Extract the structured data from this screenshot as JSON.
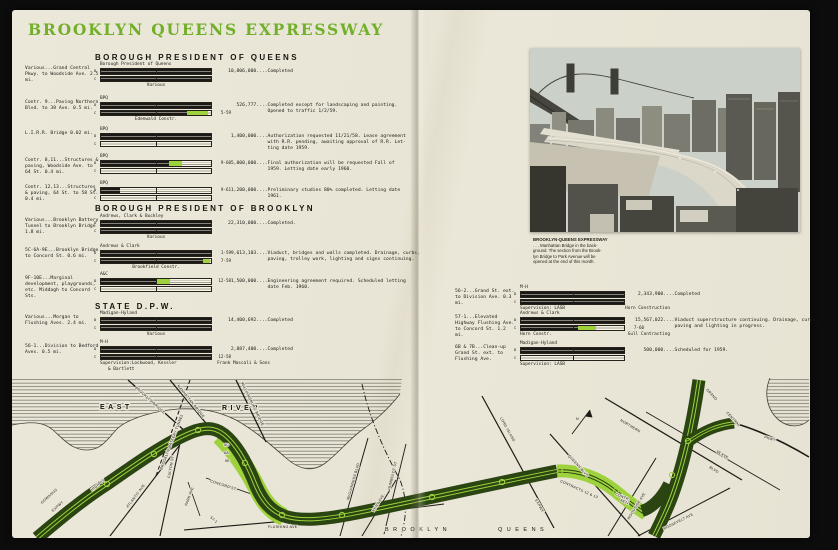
{
  "title": "BROOKLYN QUEENS EXPRESSWAY",
  "colors": {
    "accent_green": "#72b02a",
    "bar_green": "#9ed23d",
    "map_dark_green": "#2a4511",
    "map_light_green": "#9ed23d",
    "page_cream": "#e9e5d7"
  },
  "bars": {
    "d": "D",
    "c": "C"
  },
  "left": {
    "sections": [
      {
        "header": "BOROUGH PRESIDENT OF QUEENS",
        "rows": [
          {
            "label": "Various...Grand Central Pkwy. to Woodside Ave. 2.5 mi.",
            "top": "Borough President of Queens",
            "bottom": "Various",
            "d_black": 1,
            "d_green": 0,
            "c_black": 1,
            "c_green": 0,
            "amount": "10,806,000....Completed"
          },
          {
            "label": "Contr. 9...Paving Northern Blvd. to 38 Ave.  0.5 mi.",
            "top": "BPQ",
            "bottom": "Edenwald Constr.",
            "date_c": "5-59",
            "d_black": 1,
            "d_green": 0,
            "c_black": 0.78,
            "c_green": 0.19,
            "amount": "   526,777....Completed except for landscaping and painting.\n              Opened to traffic 1/2/59."
          },
          {
            "label": "L.I.R.R. Bridge 0.02 mi.",
            "top": "BPQ",
            "d_black": 1,
            "d_green": 0,
            "c_black": 0,
            "c_green": 0,
            "amount": " 1,400,000....Authorization requested 11/21/58. Lease agreement\n              with R.R. pending, awaiting approval of R.R. Let-\n              ting date 1959."
          },
          {
            "label": "Contr. 8,11...Structures & paving, Woodside Ave. to 64 St. 0.4 mi.",
            "top": "BPQ",
            "date_d": "9-60",
            "d_black": 0.62,
            "d_green": 0.12,
            "c_black": 0,
            "c_green": 0,
            "amount": " 5,000,000....Final authorization will be requested Fall of\n              1959. Letting date early 1960."
          },
          {
            "label": "Contr. 12,13...Structures & paving, 64 St. to 58 St.  0.4 mi.",
            "top": "BPQ",
            "date_d": "9-61",
            "d_black": 0.17,
            "d_green": 0,
            "c_black": 0,
            "c_green": 0,
            "amount": " 1,200,000....Preliminary studies 80% completed. Letting date\n              1961."
          }
        ]
      },
      {
        "header": "BOROUGH PRESIDENT OF BROOKLYN",
        "rows": [
          {
            "label": "Various...Brooklyn Battery Tunnel to Brooklyn Bridge 1.8 mi.",
            "top": "Andrews, Clark & Buckley",
            "bottom": "Various",
            "d_black": 1,
            "d_green": 0,
            "c_black": 1,
            "c_green": 0,
            "amount": "22,310,000....Completed."
          },
          {
            "label": "5C-6A-9E...Brooklyn Bridge to Concord St. 0.6 mi.",
            "top": "Andrews & Clark",
            "bottom": "Brookfield Constr.",
            "date_d": "1-59",
            "date_c": "7-59",
            "d_black": 1,
            "d_green": 0,
            "c_black": 0.93,
            "c_green": 0.06,
            "amount": " 9,613,103....Viaduct, bridges and walls completed. Drainage, curbs,\n              paving, trolley work, lighting and signs continuing."
          },
          {
            "label": "9F-10E...Marginal development, playgrounds, etc. Middagh to Concord Sts.",
            "top": "A&C",
            "date_d": "12-58",
            "d_black": 0.5,
            "d_green": 0.13,
            "c_black": 0,
            "c_green": 0,
            "amount": " 1,500,000....Engineering agreement required. Scheduled letting\n              date Feb. 1960."
          }
        ]
      },
      {
        "header": "STATE D.P.W.",
        "rows": [
          {
            "label": "Various...Morgan to Flushing Aves. 2.4 mi.",
            "top": "Madigan-Hyland",
            "bottom": "Various",
            "d_black": 1,
            "d_green": 0,
            "c_black": 1,
            "c_green": 0,
            "amount": "14,400,692....Completed"
          },
          {
            "label": "56-1...Division to Bedford Aves. 0.5 mi.",
            "top": "M-H",
            "date_c": "12-58",
            "d_black": 1,
            "d_green": 0,
            "c_black": 1,
            "c_green": 0,
            "sup_left": "Supervision:Lockwood, Kessler",
            "sup_left2": "& Bartlett",
            "sup_right": "Frank Mascali & Sons",
            "amount": " 2,887,400....Completed"
          }
        ]
      }
    ]
  },
  "right_page": {
    "rows": [
      {
        "label": "56-2...Grand St. ext. to Division Ave. 0.3 mi.",
        "top": "M-H",
        "d_black": 1,
        "d_green": 0,
        "c_black": 1,
        "c_green": 0,
        "sup_left": "Supervision: LASB",
        "sup_right": "Horn Construction",
        "amount": " 2,343,900....Completed"
      },
      {
        "label": "57-1...Elevated Highway Flushing Ave. to Concord St.  1.2 mi.",
        "top": "Andrews & Clark",
        "date_c": "7-60",
        "d_black": 1,
        "d_green": 0,
        "c_black": 0.55,
        "c_green": 0.18,
        "sup_left": "Horn Constr.",
        "sup_right": "Gull Contracting",
        "amount": "15,567,022....Viaduct superstructure continuing. Drainage, curbs,\n              paving and lighting in progress."
      },
      {
        "label": "6B & 7B...Clean-up Grand St. ext. to Flushing Ave.",
        "top": "Madigan-Hyland",
        "d_black": 1,
        "d_green": 0,
        "c_black": 0,
        "c_green": 0,
        "sup_left": "Supervision: LASB",
        "amount": "   500,000....Scheduled for 1959."
      }
    ]
  },
  "photo": {
    "caption": [
      "BROOKLYN-QUEENS  EXPRESSWAY",
      ". . . Manhattan Bridge in the back-",
      "ground. The section from the Brook-",
      "lyn Bridge to Park Avenue will be",
      "opened at the end of this month."
    ]
  },
  "map": {
    "labels": [
      "EAST",
      "RIVER",
      "BROOKLYN-BATTERY TUNNEL",
      "BROOKLYN BRIDGE",
      "MANHATTAN BRIDGE",
      "WILLIAMSBURG BRIDGE",
      "GOWANUS",
      "EXPWY",
      "HIGH ST",
      "FULTON ST.",
      "ATLANTIC AVE.",
      "CONCORD ST.",
      "PARK AVE",
      "5C",
      "6A",
      "9E",
      "57-1",
      "FLUSHING AVE.",
      "KENT AVE.",
      "BROOKLYN",
      "QUEENS",
      "McGUINNESS BLVD",
      "HUMBOLDT ST",
      "LONG ISLAND",
      "EXPWY",
      "CONTRACTS 12 & 13",
      "QUEENS BLVD",
      "CONTR.",
      "8&11",
      "WOODSIDE AVE",
      "ROOSEVELT AVE",
      "NORTHERN",
      "BLVD",
      "38 AVE",
      "GRAND",
      "CENTRAL",
      "PKWY",
      "N"
    ]
  }
}
